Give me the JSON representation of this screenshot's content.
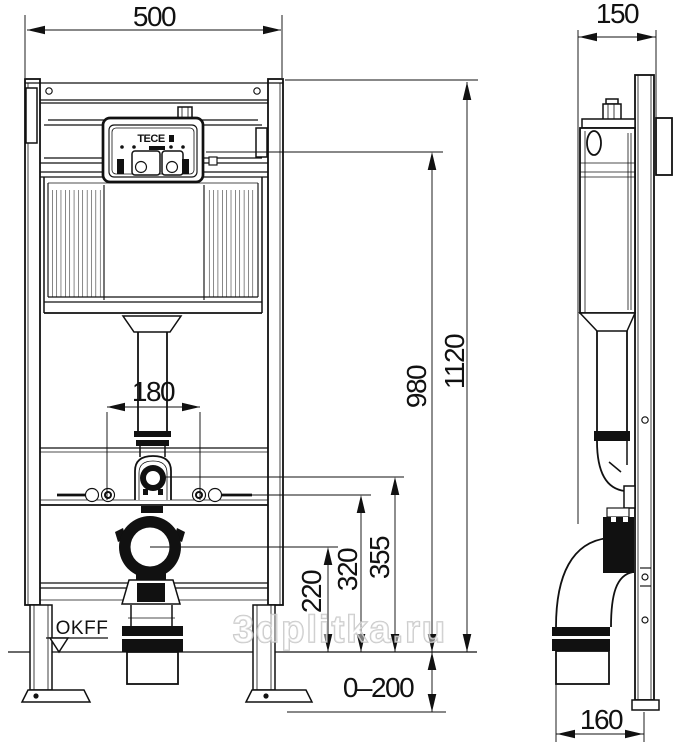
{
  "dimensions": {
    "frame_width": "500",
    "frame_depth": "150",
    "total_height": "1120",
    "actuation_height": "980",
    "flush_bend_height": "355",
    "fixing_height": "320",
    "outlet_height": "220",
    "flush_pipe_spacing": "180",
    "floor_adjust_range": "0–200",
    "outlet_offset": "160"
  },
  "labels": {
    "floor_level": "OKFF",
    "brand": "TECE"
  },
  "watermark": "3dplitka.ru"
}
